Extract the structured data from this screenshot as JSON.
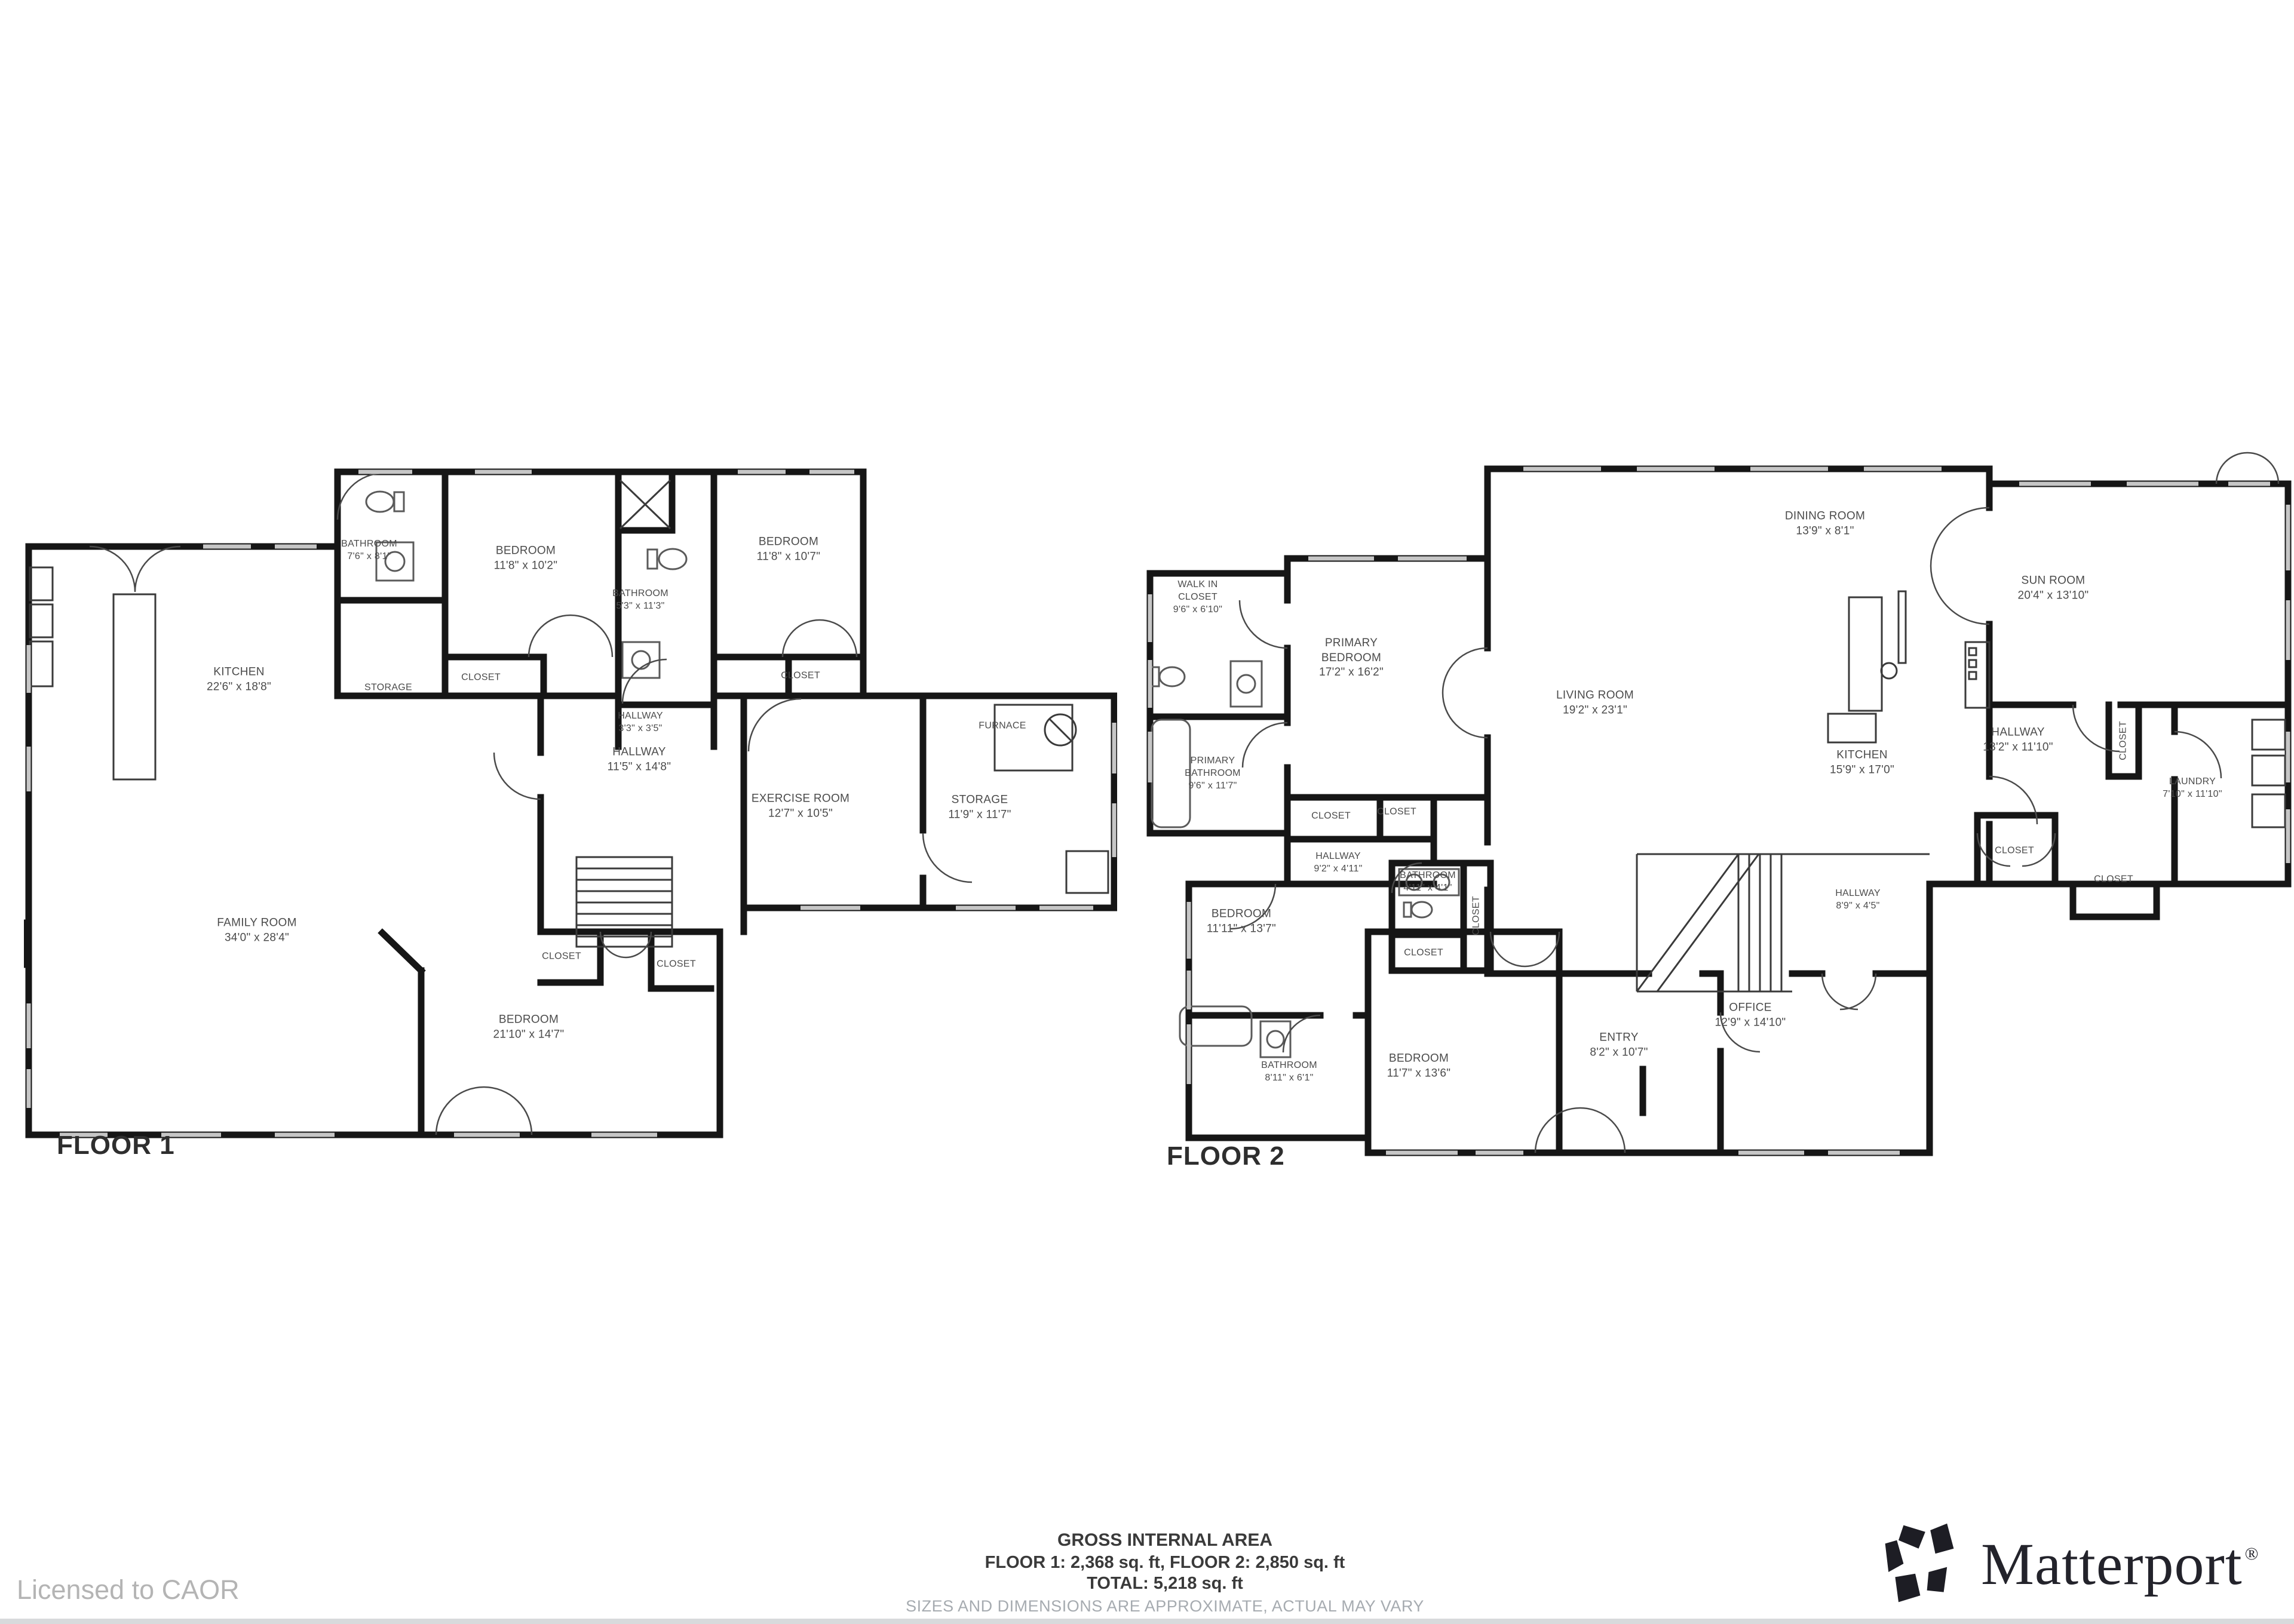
{
  "floor1": {
    "label": "FLOOR 1",
    "rooms": [
      {
        "name": "BATHROOM",
        "dims": "7'6\" x 8'1\""
      },
      {
        "name": "BEDROOM",
        "dims": "11'8\" x 10'2\""
      },
      {
        "name": "BATHROOM",
        "dims": "5'3\" x 11'3\""
      },
      {
        "name": "BEDROOM",
        "dims": "11'8\" x 10'7\""
      },
      {
        "name": "STORAGE",
        "dims": ""
      },
      {
        "name": "CLOSET",
        "dims": ""
      },
      {
        "name": "HALLWAY",
        "dims": "3'3\" x 3'5\""
      },
      {
        "name": "CLOSET",
        "dims": ""
      },
      {
        "name": "KITCHEN",
        "dims": "22'6\" x 18'8\""
      },
      {
        "name": "HALLWAY",
        "dims": "11'5\" x 14'8\""
      },
      {
        "name": "EXERCISE ROOM",
        "dims": "12'7\" x 10'5\""
      },
      {
        "name": "STORAGE",
        "dims": "11'9\" x 11'7\""
      },
      {
        "name": "FURNACE",
        "dims": ""
      },
      {
        "name": "FAMILY ROOM",
        "dims": "34'0\" x 28'4\""
      },
      {
        "name": "CLOSET",
        "dims": ""
      },
      {
        "name": "CLOSET",
        "dims": ""
      },
      {
        "name": "BEDROOM",
        "dims": "21'10\" x 14'7\""
      }
    ]
  },
  "floor2": {
    "label": "FLOOR 2",
    "rooms": [
      {
        "name": "WALK IN CLOSET",
        "dims": "9'6\" x 6'10\""
      },
      {
        "name": "PRIMARY BEDROOM",
        "dims": "17'2\" x 16'2\""
      },
      {
        "name": "PRIMARY BATHROOM",
        "dims": "9'6\" x 11'7\""
      },
      {
        "name": "CLOSET",
        "dims": ""
      },
      {
        "name": "CLOSET",
        "dims": ""
      },
      {
        "name": "HALLWAY",
        "dims": "9'2\" x 4'11\""
      },
      {
        "name": "BEDROOM",
        "dims": "11'11\" x 13'7\""
      },
      {
        "name": "BATHROOM",
        "dims": "4'11\" x 4'1\""
      },
      {
        "name": "CLOSET",
        "dims": ""
      },
      {
        "name": "CLOSET",
        "dims": ""
      },
      {
        "name": "BATHROOM",
        "dims": "8'11\" x 6'1\""
      },
      {
        "name": "BEDROOM",
        "dims": "11'7\" x 13'6\""
      },
      {
        "name": "DINING ROOM",
        "dims": "13'9\" x 8'1\""
      },
      {
        "name": "LIVING ROOM",
        "dims": "19'2\" x 23'1\""
      },
      {
        "name": "KITCHEN",
        "dims": "15'9\" x 17'0\""
      },
      {
        "name": "SUN ROOM",
        "dims": "20'4\" x 13'10\""
      },
      {
        "name": "HALLWAY",
        "dims": "13'2\" x 11'10\""
      },
      {
        "name": "LAUNDRY",
        "dims": "7'10\" x 11'10\""
      },
      {
        "name": "CLOSET",
        "dims": ""
      },
      {
        "name": "CLOSET",
        "dims": ""
      },
      {
        "name": "CLOSET",
        "dims": ""
      },
      {
        "name": "HALLWAY",
        "dims": "8'9\" x 4'5\""
      },
      {
        "name": "ENTRY",
        "dims": "8'2\" x 10'7\""
      },
      {
        "name": "OFFICE",
        "dims": "12'9\" x 14'10\""
      }
    ]
  },
  "footer": {
    "title": "GROSS INTERNAL AREA",
    "line1": "FLOOR 1: 2,368 sq. ft, FLOOR 2: 2,850 sq. ft",
    "line2": "TOTAL: 5,218 sq. ft",
    "disclaimer": "SIZES AND DIMENSIONS ARE APPROXIMATE, ACTUAL MAY VARY"
  },
  "license": "Licensed to CAOR",
  "brand": {
    "name": "Matterport",
    "registered": "®"
  },
  "colors": {
    "wall": "#161616",
    "label": "#4b4b4b",
    "muted": "#a6abb0",
    "window": "#c6c6c6"
  }
}
